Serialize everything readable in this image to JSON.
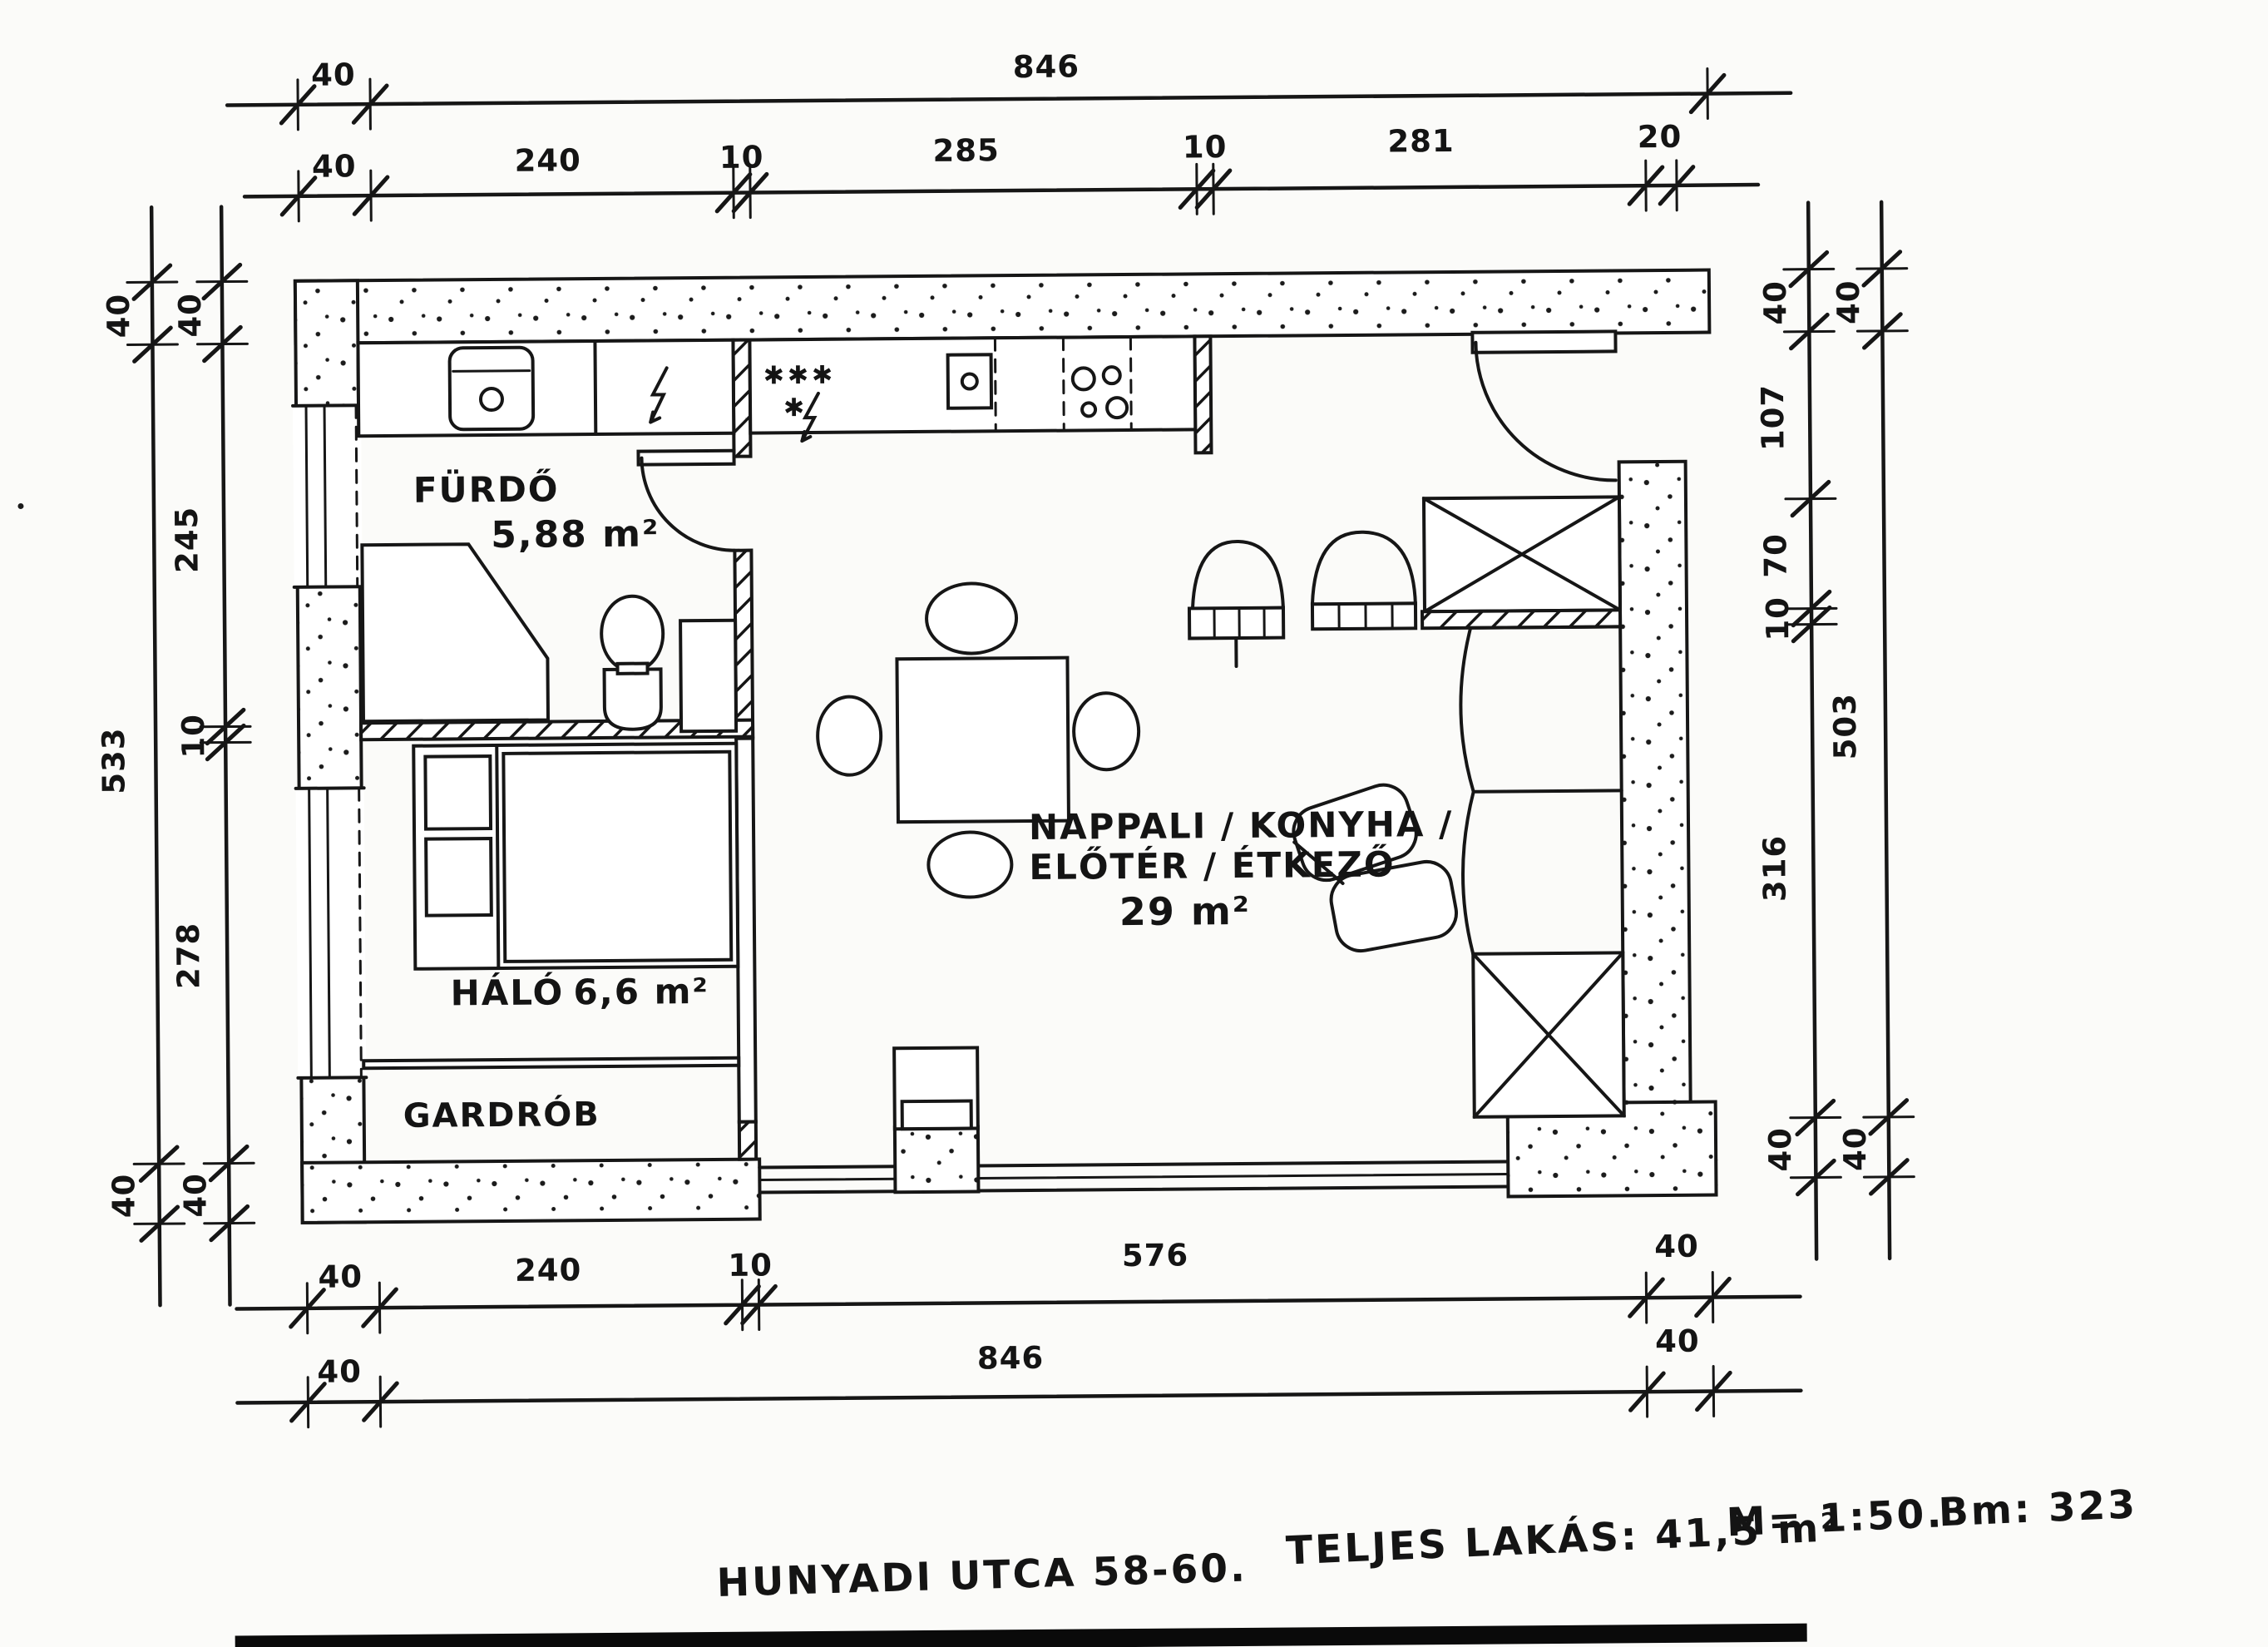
{
  "plan": {
    "rooms": {
      "bathroom": {
        "name": "FÜRDŐ",
        "area": "5,88 m²"
      },
      "bedroom": {
        "name": "HÁLÓ",
        "area": "6,6 m²"
      },
      "wardrobe": {
        "name": "GARDRÓB"
      },
      "living": {
        "line1": "NAPPALI / KONYHA /",
        "line2": "ELŐTÉR / ÉTKEZŐ",
        "area": "29 m²"
      }
    },
    "symbols": {
      "stars": "✱✱✱",
      "star": "✱"
    }
  },
  "dimensions": {
    "top_overall": [
      "40",
      "846"
    ],
    "top_detail": [
      "40",
      "240",
      "10",
      "285",
      "10",
      "281",
      "20"
    ],
    "left_outer": [
      "40",
      "533",
      "40"
    ],
    "left_inner": [
      "40",
      "245",
      "10",
      "278",
      "40"
    ],
    "right_inner": [
      "40",
      "107",
      "70",
      "10",
      "316",
      "40"
    ],
    "right_outer": [
      "40",
      "503",
      "40"
    ],
    "bottom_detail": [
      "40",
      "240",
      "10",
      "576",
      "40"
    ],
    "bottom_overall": [
      "40",
      "846",
      "40"
    ]
  },
  "footer": {
    "address": "HUNYADI UTCA 58-60.",
    "total_area": "TELJES LAKÁS: 41,5 m²",
    "scale": "M= 1:50.",
    "bm": "Bm: 323"
  },
  "colors": {
    "ink": "#161616",
    "paper": "#fbfbf9"
  }
}
